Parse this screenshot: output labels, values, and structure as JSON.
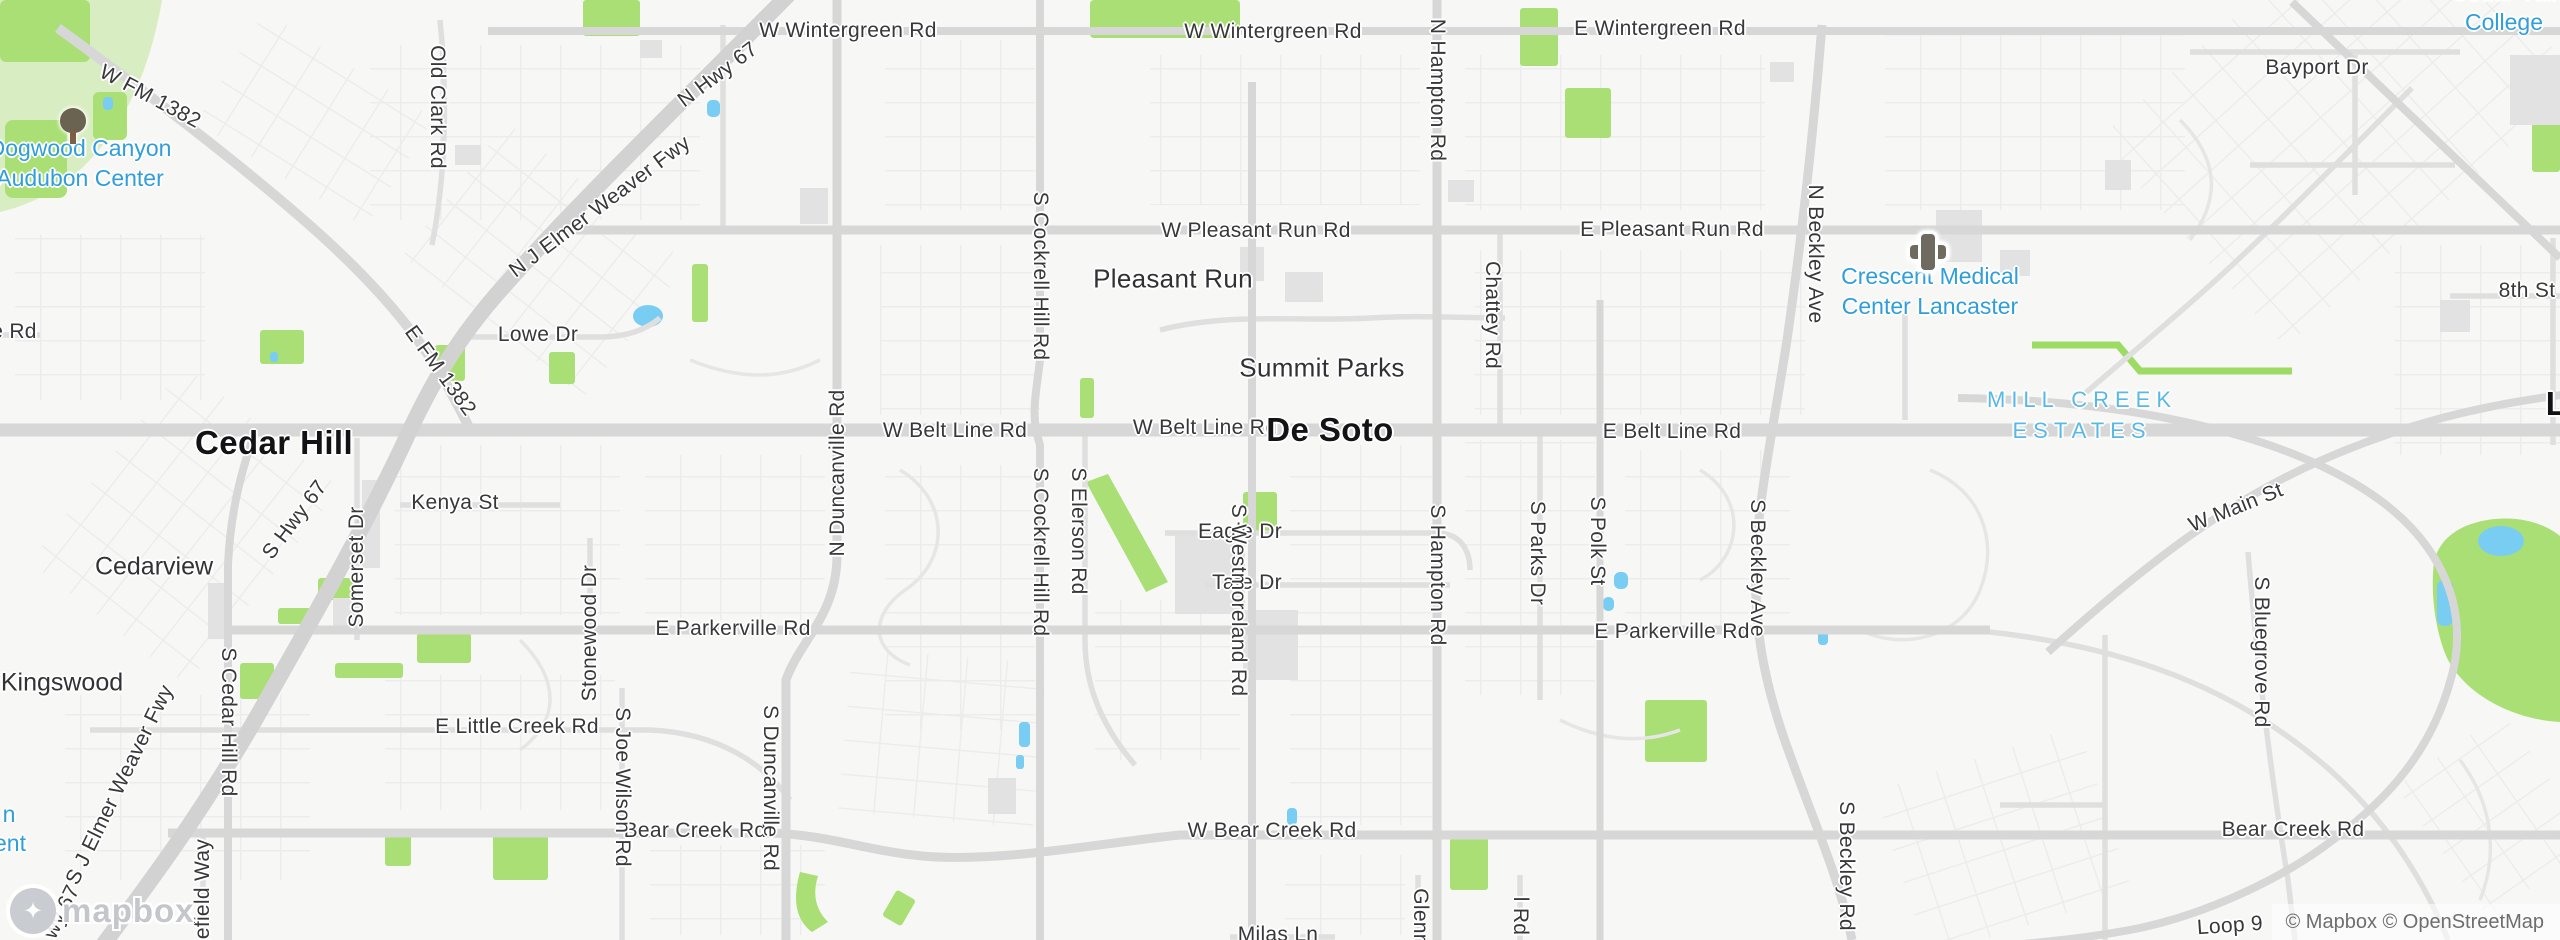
{
  "map": {
    "attribution": "© Mapbox © OpenStreetMap",
    "logo_text": "mapbox",
    "colors": {
      "poi_blue": "#2f9edb",
      "estates_blue": "#58b8e8",
      "park_green": "#aadf76",
      "pale_park_green": "#d9edc2",
      "water_blue": "#79cdf2",
      "major_road": "#d7d7d7",
      "freeway": "#d2d2d2",
      "road_label": "#38383a",
      "city_label": "#131316"
    },
    "labels": [
      {
        "id": "road-w-wintergreen-1",
        "cls": "road",
        "text": "W Wintergreen Rd",
        "x": 848,
        "y": 31
      },
      {
        "id": "road-w-wintergreen-2",
        "cls": "road",
        "text": "W Wintergreen Rd",
        "x": 1273,
        "y": 32
      },
      {
        "id": "road-e-wintergreen",
        "cls": "road",
        "text": "E Wintergreen Rd",
        "x": 1660,
        "y": 29
      },
      {
        "id": "road-bayport-dr",
        "cls": "road",
        "text": "Bayport Dr",
        "x": 2317,
        "y": 68
      },
      {
        "id": "road-w-pleasant-run",
        "cls": "road",
        "text": "W Pleasant Run Rd",
        "x": 1256,
        "y": 231
      },
      {
        "id": "road-e-pleasant-run",
        "cls": "road",
        "text": "E Pleasant Run Rd",
        "x": 1672,
        "y": 230
      },
      {
        "id": "road-8th-st",
        "cls": "road",
        "text": "8th St",
        "x": 2527,
        "y": 291
      },
      {
        "id": "road-lowe-dr",
        "cls": "road",
        "text": "Lowe Dr",
        "x": 538,
        "y": 335
      },
      {
        "id": "road-w-belt-line-1",
        "cls": "road",
        "text": "W Belt Line Rd",
        "x": 955,
        "y": 431
      },
      {
        "id": "road-w-belt-line-2",
        "cls": "road",
        "text": "W Belt Line Rd",
        "x": 1205,
        "y": 428
      },
      {
        "id": "road-e-belt-line",
        "cls": "road",
        "text": "E Belt Line Rd",
        "x": 1672,
        "y": 432
      },
      {
        "id": "road-kenya-st",
        "cls": "road",
        "text": "Kenya St",
        "x": 455,
        "y": 503
      },
      {
        "id": "road-eagle-dr",
        "cls": "road",
        "text": "Eagle Dr",
        "x": 1240,
        "y": 532
      },
      {
        "id": "road-tate-dr",
        "cls": "road",
        "text": "Tate Dr",
        "x": 1247,
        "y": 583
      },
      {
        "id": "road-e-parkerville-1",
        "cls": "road",
        "text": "E Parkerville Rd",
        "x": 733,
        "y": 629
      },
      {
        "id": "road-e-parkerville-2",
        "cls": "road",
        "text": "E Parkerville Rd",
        "x": 1672,
        "y": 632
      },
      {
        "id": "road-e-little-creek",
        "cls": "road",
        "text": "E Little Creek Rd",
        "x": 517,
        "y": 727
      },
      {
        "id": "road-bear-creek-1",
        "cls": "road",
        "text": "Bear Creek Rd",
        "x": 695,
        "y": 831
      },
      {
        "id": "road-w-bear-creek",
        "cls": "road",
        "text": "W Bear Creek Rd",
        "x": 1272,
        "y": 831
      },
      {
        "id": "road-bear-creek-2",
        "cls": "road",
        "text": "Bear Creek Rd",
        "x": 2293,
        "y": 830
      },
      {
        "id": "road-milas-ln",
        "cls": "road",
        "text": "Milas Ln",
        "x": 1278,
        "y": 935
      },
      {
        "id": "road-loop-9",
        "cls": "road",
        "text": "Loop 9",
        "x": 2230,
        "y": 926,
        "rot": -4
      },
      {
        "id": "road-w-main-st",
        "cls": "road",
        "text": "W Main St",
        "x": 2236,
        "y": 508,
        "rot": -22
      },
      {
        "id": "road-e-rd-fragment",
        "cls": "road",
        "text": "e Rd",
        "x": 14,
        "y": 332
      },
      {
        "id": "road-w-fm-1382",
        "cls": "road",
        "text": "W FM 1382",
        "x": 150,
        "y": 97,
        "rot": 28
      },
      {
        "id": "road-n-hwy-67",
        "cls": "road",
        "text": "N Hwy 67",
        "x": 718,
        "y": 75,
        "rot": -37
      },
      {
        "id": "road-n-j-elmer-weaver-fwy",
        "cls": "road",
        "text": "N J Elmer Weaver Fwy",
        "x": 600,
        "y": 207,
        "rot": -37
      },
      {
        "id": "road-e-fm-1382",
        "cls": "road",
        "text": "E FM 1382",
        "x": 440,
        "y": 371,
        "rot": 54
      },
      {
        "id": "road-s-hwy-67",
        "cls": "road",
        "text": "S Hwy 67",
        "x": 295,
        "y": 520,
        "rot": -53
      },
      {
        "id": "road-s-j-elmer-weaver-fwy",
        "cls": "road",
        "text": "S J Elmer Weaver Fwy",
        "x": 120,
        "y": 785,
        "rot": -64
      },
      {
        "id": "road-s-hwy-67-fragment",
        "cls": "road",
        "text": "wy 67",
        "x": 62,
        "y": 912,
        "rot": -64
      },
      {
        "id": "road-old-clark",
        "cls": "road",
        "text": "Old Clark Rd",
        "x": 437,
        "y": 107,
        "rot": 90
      },
      {
        "id": "road-n-hampton",
        "cls": "road",
        "text": "N Hampton Rd",
        "x": 1437,
        "y": 90,
        "rot": 90
      },
      {
        "id": "road-s-hampton",
        "cls": "road",
        "text": "S Hampton Rd",
        "x": 1437,
        "y": 575,
        "rot": 90
      },
      {
        "id": "road-chattey",
        "cls": "road",
        "text": "Chattey Rd",
        "x": 1492,
        "y": 315,
        "rot": 90
      },
      {
        "id": "road-n-beckley",
        "cls": "road",
        "text": "N Beckley Ave",
        "x": 1815,
        "y": 254,
        "rot": 90
      },
      {
        "id": "road-s-beckley-ave",
        "cls": "road",
        "text": "S Beckley Ave",
        "x": 1757,
        "y": 568,
        "rot": 90
      },
      {
        "id": "road-s-beckley-rd",
        "cls": "road",
        "text": "S Beckley Rd",
        "x": 1846,
        "y": 866,
        "rot": 90
      },
      {
        "id": "road-s-cockrell-hill-1",
        "cls": "road",
        "text": "S Cockrell Hill Rd",
        "x": 1040,
        "y": 276,
        "rot": 90
      },
      {
        "id": "road-s-cockrell-hill-2",
        "cls": "road",
        "text": "S Cockrell Hill Rd",
        "x": 1040,
        "y": 552,
        "rot": 90
      },
      {
        "id": "road-s-elerson",
        "cls": "road",
        "text": "S Elerson Rd",
        "x": 1078,
        "y": 531,
        "rot": 90
      },
      {
        "id": "road-s-westmoreland",
        "cls": "road",
        "text": "S Westmoreland Rd",
        "x": 1238,
        "y": 600,
        "rot": 90
      },
      {
        "id": "road-s-parks-dr",
        "cls": "road",
        "text": "S Parks Dr",
        "x": 1537,
        "y": 553,
        "rot": 90
      },
      {
        "id": "road-s-polk-st",
        "cls": "road",
        "text": "S Polk St",
        "x": 1597,
        "y": 541,
        "rot": 90
      },
      {
        "id": "road-s-duncanville",
        "cls": "road",
        "text": "S Duncanville Rd",
        "x": 770,
        "y": 788,
        "rot": 90
      },
      {
        "id": "road-n-duncanville",
        "cls": "road",
        "text": "N Duncanville Rd",
        "x": 838,
        "y": 473,
        "rot": -90
      },
      {
        "id": "road-somerset-dr",
        "cls": "road",
        "text": "Somerset Dr",
        "x": 357,
        "y": 567,
        "rot": -90
      },
      {
        "id": "road-stonewood-dr",
        "cls": "road",
        "text": "Stonewood Dr",
        "x": 590,
        "y": 633,
        "rot": -90
      },
      {
        "id": "road-s-cedar-hill",
        "cls": "road",
        "text": "S Cedar Hill Rd",
        "x": 228,
        "y": 722,
        "rot": 90
      },
      {
        "id": "road-s-joe-wilson",
        "cls": "road",
        "text": "S Joe Wilson Rd",
        "x": 622,
        "y": 787,
        "rot": 90
      },
      {
        "id": "road-s-bluegrove",
        "cls": "road",
        "text": "S Bluegrove Rd",
        "x": 2261,
        "y": 652,
        "rot": 90
      },
      {
        "id": "road-edgefield-way-fragment",
        "cls": "road",
        "text": "gefield Way",
        "x": 203,
        "y": 895,
        "rot": -90
      },
      {
        "id": "road-glenn-fragment",
        "cls": "road",
        "text": "Glenn",
        "x": 1420,
        "y": 917,
        "rot": 90
      },
      {
        "id": "road-l-rd-fragment",
        "cls": "road",
        "text": "l Rd",
        "x": 1520,
        "y": 916,
        "rot": 90
      },
      {
        "id": "city-cedar-hill",
        "cls": "citybig",
        "text": "Cedar Hill",
        "x": 274,
        "y": 443
      },
      {
        "id": "city-de-soto",
        "cls": "citybig",
        "text": "De Soto",
        "x": 1330,
        "y": 430
      },
      {
        "id": "city-lancaster-fragment",
        "cls": "citybig",
        "text": "L",
        "x": 2556,
        "y": 404
      },
      {
        "id": "city-pleasant-run",
        "cls": "citymed",
        "text": "Pleasant Run",
        "x": 1173,
        "y": 279
      },
      {
        "id": "city-summit-parks",
        "cls": "citymed",
        "text": "Summit Parks",
        "x": 1322,
        "y": 368
      },
      {
        "id": "city-cedarview",
        "cls": "citysm",
        "text": "Cedarview",
        "x": 154,
        "y": 567
      },
      {
        "id": "city-kingswood",
        "cls": "citysm",
        "text": "Kingswood",
        "x": 62,
        "y": 683
      },
      {
        "id": "poi-dogwood-canyon-audubon-center",
        "cls": "poi",
        "lines": [
          "Dogwood Canyon",
          "Audubon Center"
        ],
        "x": 80,
        "y": 164
      },
      {
        "id": "poi-crescent-medical-center",
        "cls": "poi",
        "lines": [
          "Crescent Medical",
          "Center Lancaster"
        ],
        "x": 1930,
        "y": 292
      },
      {
        "id": "poi-mill-creek-estates",
        "cls": "poicaps",
        "lines": [
          "MILL CREEK",
          "ESTATES"
        ],
        "x": 2082,
        "y": 416
      },
      {
        "id": "poi-cedar-valley-college",
        "cls": "poi",
        "lines": [
          "Cedar Vall",
          "College"
        ],
        "x": 2504,
        "y": 8
      },
      {
        "id": "poi-fragment-n",
        "cls": "poi",
        "text": "n",
        "x": 9,
        "y": 815
      },
      {
        "id": "poi-fragment-ent",
        "cls": "poi",
        "text": "ent",
        "x": 10,
        "y": 844
      }
    ],
    "icons": [
      {
        "id": "park-tree-icon",
        "type": "tree",
        "x": 73,
        "y": 127
      },
      {
        "id": "hospital-cross-icon",
        "type": "cross",
        "x": 1928,
        "y": 252
      }
    ]
  }
}
